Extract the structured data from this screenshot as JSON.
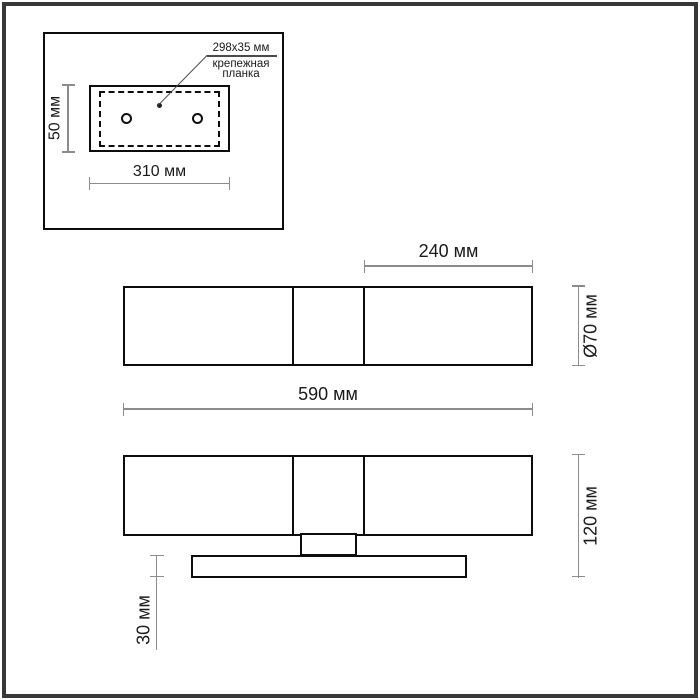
{
  "drawing": {
    "type": "fixture-dimension-diagram",
    "units": "мм"
  },
  "colors": {
    "background": "#ffffff",
    "outline": "#0d0d0d",
    "dimension_line": "#8c8c8c",
    "text": "#1a1a1a",
    "frame_border": "#383838"
  },
  "inset_detail": {
    "callout": {
      "size_label": "298x35 мм",
      "name_line1": "крепежная",
      "name_line2": "планка"
    },
    "height_dim": "50 мм",
    "width_dim": "310 мм"
  },
  "top_view": {
    "shade_width_dim": "240 мм",
    "diameter_dim": "Ø70 мм",
    "overall_width_dim": "590 мм"
  },
  "front_view": {
    "overall_height_dim": "120 мм",
    "backplate_height_dim": "30 мм"
  }
}
